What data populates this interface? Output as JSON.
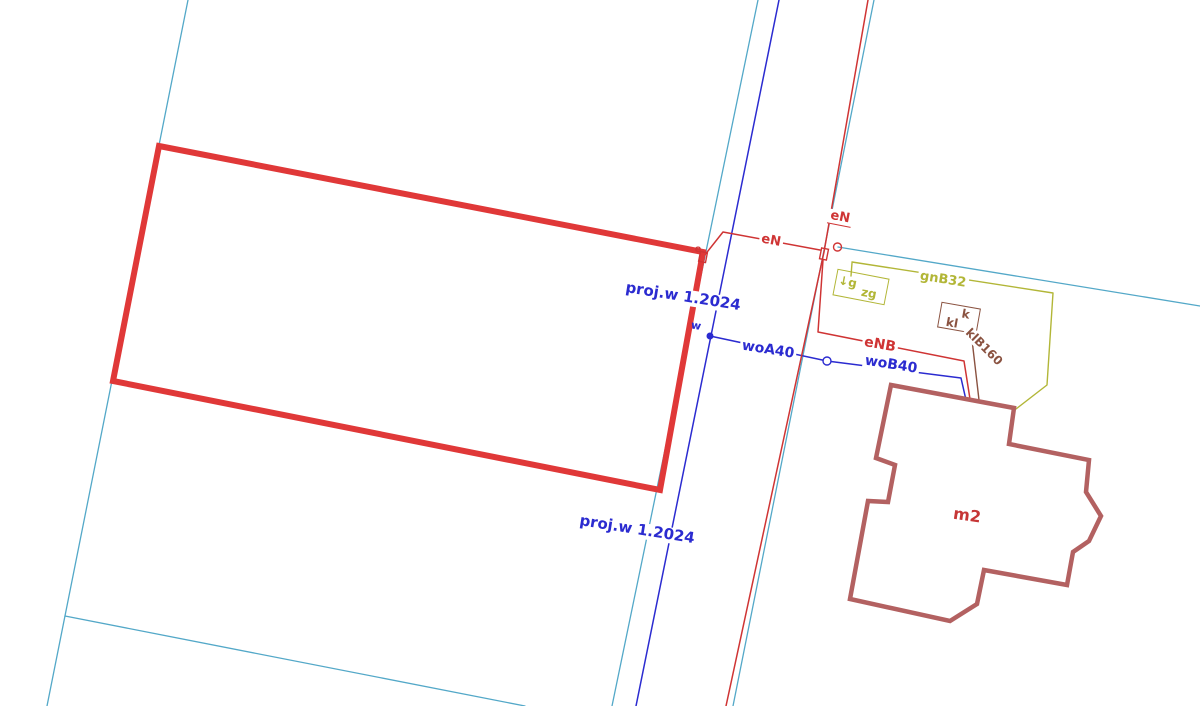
{
  "map": {
    "width": 1200,
    "height": 706,
    "background": "#ffffff",
    "colors": {
      "boundary": "#53a8c8",
      "water": "#2b2bd0",
      "power": "#cf3434",
      "design": "#e03838",
      "gas": "#b2b637",
      "sewer": "#8a5240",
      "building": "#b36161",
      "building_label": "#c63636"
    },
    "lines": [
      {
        "name": "parcel-boundary-left",
        "color": "boundary",
        "width": 1.3,
        "points": [
          [
            188,
            0
          ],
          [
            47,
            706
          ]
        ]
      },
      {
        "name": "parcel-boundary-bottom",
        "color": "boundary",
        "width": 1.3,
        "points": [
          [
            65,
            616
          ],
          [
            525,
            706
          ]
        ]
      },
      {
        "name": "parcel-boundary-center-left",
        "color": "boundary",
        "width": 1.3,
        "points": [
          [
            758,
            0
          ],
          [
            612,
            706
          ]
        ]
      },
      {
        "name": "parcel-boundary-center-right",
        "color": "boundary",
        "width": 1.3,
        "points": [
          [
            874,
            0
          ],
          [
            733,
            706
          ]
        ]
      },
      {
        "name": "parcel-boundary-right",
        "color": "boundary",
        "width": 1.3,
        "points": [
          [
            838,
            247
          ],
          [
            1200,
            306
          ]
        ]
      },
      {
        "name": "gas-line-gnB32",
        "color": "gas",
        "width": 1.4,
        "points": [
          [
            852,
            262
          ],
          [
            1053,
            293
          ],
          [
            1047,
            385
          ],
          [
            1016,
            409
          ]
        ]
      },
      {
        "name": "gas-valve-stub",
        "color": "gas",
        "width": 1.4,
        "points": [
          [
            852,
            263
          ],
          [
            851,
            276
          ]
        ]
      },
      {
        "name": "sewer-line-klB160",
        "color": "sewer",
        "width": 1.4,
        "points": [
          [
            971,
            331
          ],
          [
            979,
            400
          ]
        ]
      },
      {
        "name": "water-main-line",
        "color": "water",
        "width": 1.5,
        "points": [
          [
            779,
            0
          ],
          [
            636,
            706
          ]
        ]
      },
      {
        "name": "water-connection-wo",
        "color": "water",
        "width": 1.5,
        "points": [
          [
            710,
            336
          ],
          [
            827,
            361
          ],
          [
            961,
            378
          ],
          [
            966,
            400
          ]
        ]
      },
      {
        "name": "power-main-line-eN",
        "color": "power",
        "width": 1.5,
        "points": [
          [
            868,
            0
          ],
          [
            824,
            252
          ],
          [
            726,
            706
          ]
        ]
      },
      {
        "name": "power-branch-eN",
        "color": "power",
        "width": 1.5,
        "points": [
          [
            704,
            256
          ],
          [
            723,
            232
          ],
          [
            820,
            250
          ]
        ]
      },
      {
        "name": "power-connection-eNB",
        "color": "power",
        "width": 1.5,
        "points": [
          [
            823,
            260
          ],
          [
            818,
            332
          ],
          [
            964,
            361
          ],
          [
            970,
            399
          ]
        ]
      }
    ],
    "polygons": [
      {
        "name": "designed-parcel-rectangle",
        "color": "design",
        "width": 6,
        "points": [
          [
            159,
            146
          ],
          [
            703,
            252
          ],
          [
            660,
            490
          ],
          [
            113,
            381
          ]
        ]
      },
      {
        "name": "building-outline-m2",
        "color": "building",
        "width": 4.5,
        "points": [
          [
            891,
            385
          ],
          [
            1014,
            408
          ],
          [
            1009,
            444
          ],
          [
            1089,
            460
          ],
          [
            1086,
            492
          ],
          [
            1101,
            516
          ],
          [
            1089,
            541
          ],
          [
            1073,
            552
          ],
          [
            1067,
            585
          ],
          [
            984,
            570
          ],
          [
            977,
            604
          ],
          [
            950,
            621
          ],
          [
            850,
            599
          ],
          [
            868,
            501
          ],
          [
            888,
            502
          ],
          [
            895,
            465
          ],
          [
            876,
            458
          ]
        ]
      }
    ],
    "symbols": [
      {
        "name": "power-junction-square",
        "type": "square",
        "x": 824,
        "y": 254,
        "w": 7,
        "h": 11,
        "rotate": 11,
        "color": "power"
      },
      {
        "name": "power-corner-square",
        "type": "square",
        "x": 703,
        "y": 257,
        "w": 7,
        "h": 10,
        "rotate": 11,
        "color": "power"
      },
      {
        "name": "power-pole-circle",
        "type": "circle",
        "x": 837.5,
        "y": 247,
        "r": 4,
        "color": "power",
        "fill": "none"
      },
      {
        "name": "water-fitting-circle",
        "type": "circle",
        "x": 827,
        "y": 361,
        "r": 4,
        "color": "water",
        "fill": "#ffffff"
      },
      {
        "name": "water-node-dot",
        "type": "dot",
        "x": 710,
        "y": 336,
        "r": 2.8,
        "color": "water"
      }
    ],
    "boxes": [
      {
        "name": "gas-valve-box-zg",
        "x": 861,
        "y": 287,
        "w": 51,
        "h": 25,
        "rotate": 11,
        "color": "gas",
        "texts": [
          {
            "name": "gas-valve-symbol",
            "text": "↓g",
            "dx": -14,
            "dy": -3,
            "size": 12
          },
          {
            "name": "gas-valve-label",
            "text": "zg",
            "dx": 9,
            "dy": 4,
            "size": 12
          }
        ]
      },
      {
        "name": "sewer-manhole-box-kl",
        "x": 959,
        "y": 318,
        "w": 38,
        "h": 24,
        "rotate": 10,
        "color": "sewer",
        "texts": [
          {
            "name": "sewer-box-label-k",
            "text": "k",
            "dx": 6,
            "dy": -5,
            "size": 12
          },
          {
            "name": "sewer-box-label-kl",
            "text": "kl",
            "dx": -6,
            "dy": 6,
            "size": 12
          }
        ]
      }
    ],
    "labels": [
      {
        "name": "design-label-proj-upper",
        "text": "proj.w 1.2024",
        "x": 683,
        "y": 297,
        "rotate": 9,
        "size": 15,
        "color": "water",
        "bg": true
      },
      {
        "name": "design-label-proj-lower",
        "text": "proj.w 1.2024",
        "x": 637,
        "y": 530,
        "rotate": 9,
        "size": 15,
        "color": "water",
        "bg": true
      },
      {
        "name": "power-label-eN-branch",
        "text": "eN",
        "x": 771,
        "y": 241,
        "rotate": 11,
        "size": 13,
        "color": "power",
        "bg": true
      },
      {
        "name": "power-label-eN-main",
        "text": "eN",
        "x": 840,
        "y": 218,
        "rotate": 11,
        "size": 13,
        "color": "power",
        "bg": true,
        "underline": true
      },
      {
        "name": "power-label-eNB",
        "text": "eNB",
        "x": 880,
        "y": 345,
        "rotate": 10,
        "size": 14,
        "color": "power",
        "bg": true
      },
      {
        "name": "water-label-woA40",
        "text": "woA40",
        "x": 768,
        "y": 350,
        "rotate": 9,
        "size": 14,
        "color": "water",
        "bg": true
      },
      {
        "name": "water-label-woB40",
        "text": "woB40",
        "x": 891,
        "y": 365,
        "rotate": 9,
        "size": 14,
        "color": "water",
        "bg": true
      },
      {
        "name": "gas-label-gnB32",
        "text": "gnB32",
        "x": 943,
        "y": 280,
        "rotate": 9,
        "size": 13,
        "color": "gas",
        "bg": true
      },
      {
        "name": "sewer-label-klB160",
        "text": "klB160",
        "x": 984,
        "y": 347,
        "rotate": 45,
        "size": 12,
        "color": "sewer",
        "bg": true
      },
      {
        "name": "building-label-m2",
        "text": "m2",
        "x": 967,
        "y": 516,
        "rotate": 8,
        "size": 16,
        "color": "building_label",
        "bg": false
      },
      {
        "name": "water-marker-w",
        "text": "w",
        "x": 696,
        "y": 326,
        "rotate": 9,
        "size": 11,
        "color": "water",
        "bg": false
      },
      {
        "name": "power-marker-e",
        "text": "e",
        "x": 698,
        "y": 250,
        "rotate": 0,
        "size": 10,
        "color": "power",
        "bg": false
      }
    ]
  }
}
